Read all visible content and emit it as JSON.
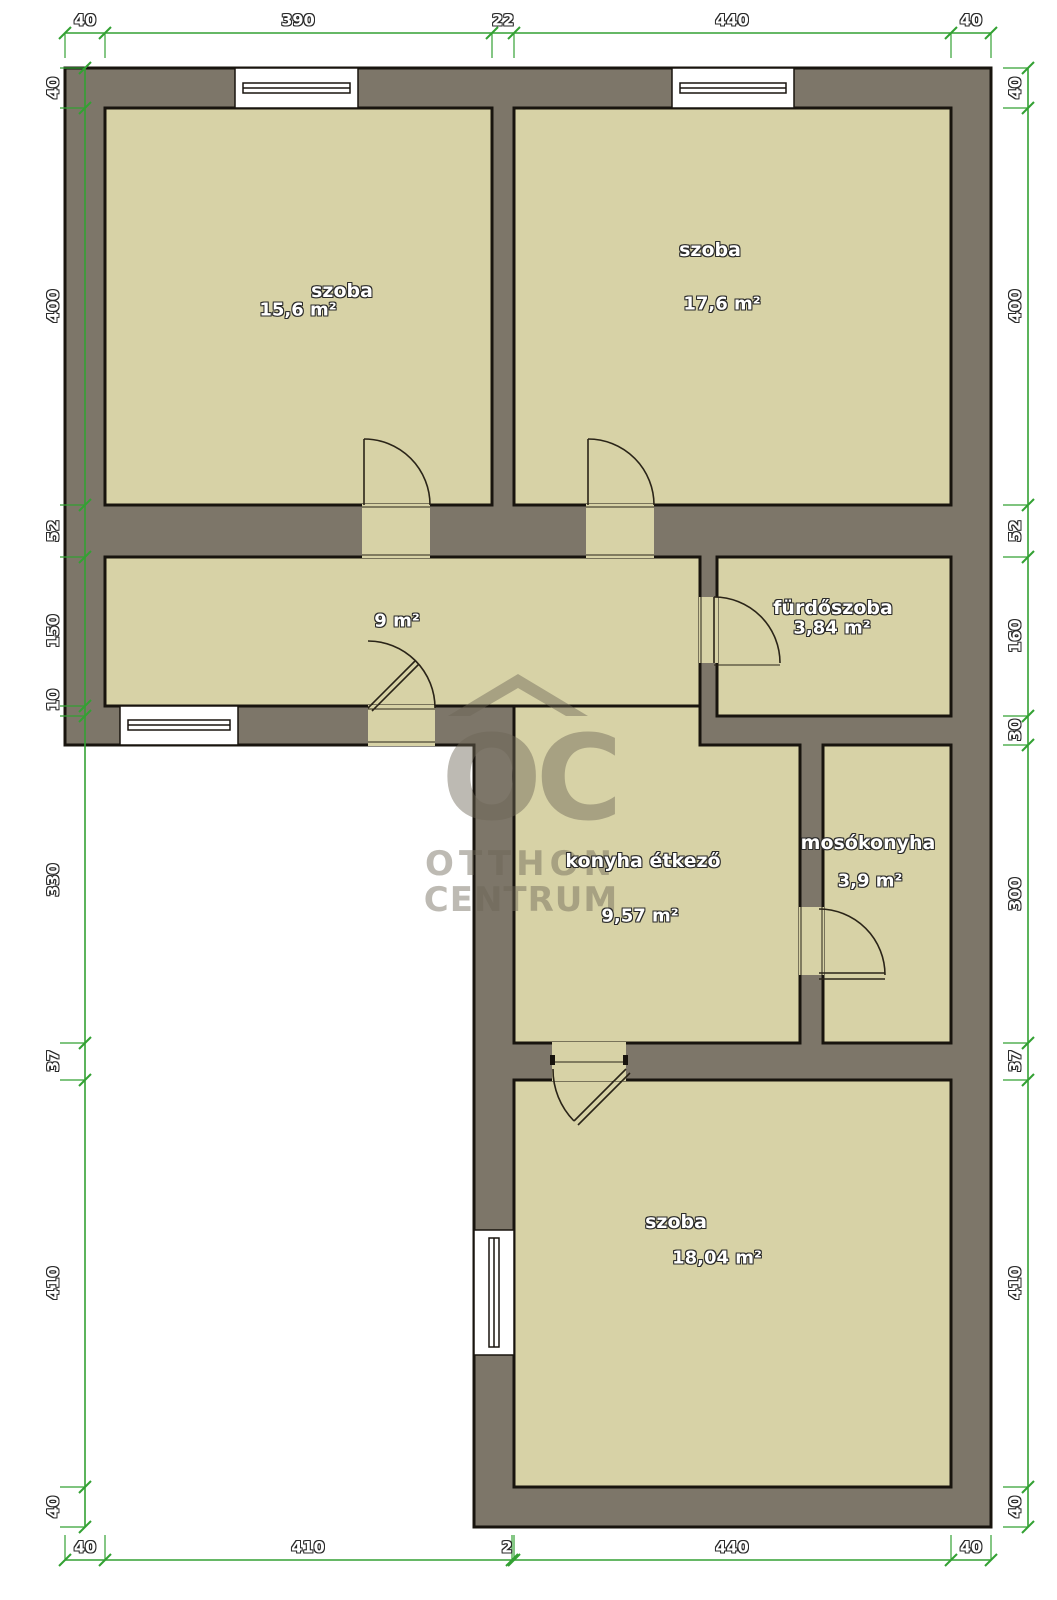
{
  "rooms": [
    {
      "name": "szoba",
      "area": "15,6 m²"
    },
    {
      "name": "szoba",
      "area": "17,6 m²"
    },
    {
      "name": "",
      "area": "9 m²"
    },
    {
      "name": "fürdőszoba",
      "area": "3,84 m²"
    },
    {
      "name": "konyha étkező",
      "area": "9,57 m²"
    },
    {
      "name": "mosókonyha",
      "area": "3,9 m²"
    },
    {
      "name": "szoba",
      "area": "18,04 m²"
    }
  ],
  "dims": {
    "top": [
      "40",
      "390",
      "22",
      "440",
      "40"
    ],
    "bottom": [
      "40",
      "410",
      "2",
      "440",
      "40"
    ],
    "left": [
      "40",
      "400",
      "52",
      "150",
      "10",
      "330",
      "37",
      "410",
      "40"
    ],
    "right": [
      "40",
      "400",
      "52",
      "160",
      "30",
      "300",
      "37",
      "410",
      "40"
    ]
  },
  "watermark": {
    "logo": "OC",
    "line1": "OTTHON",
    "line2": "CENTRUM"
  },
  "colors": {
    "wall": "#7d7669",
    "room": "#d7d2a6",
    "dimension_green": "#33a133"
  }
}
